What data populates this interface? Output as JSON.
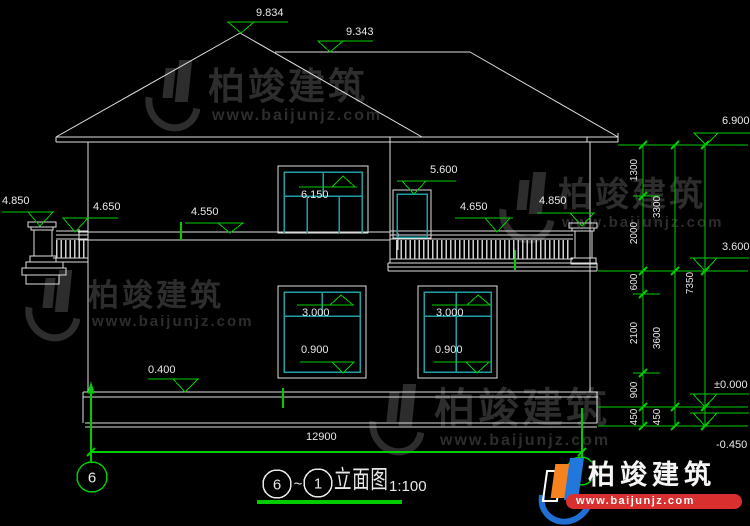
{
  "drawing": {
    "title": {
      "axis_left": "6",
      "separator": "~",
      "axis_right": "1",
      "name": "立面图",
      "scale": "1:100"
    },
    "axis_bubble_left": "6",
    "elevations": {
      "roof_peak": "9.834",
      "roof_ridge": "9.343",
      "eave": "6.900",
      "door2f_head": "6.150",
      "window2f_head": "5.600",
      "parapet_left": "4.850",
      "railing_left": "4.650",
      "belt": "4.550",
      "railing_right": "4.650",
      "parapet_right": "4.850",
      "window_head": "3.000",
      "window_sill": "0.900",
      "plinth_top": "0.400",
      "floor2": "3.600",
      "zero": "±0.000",
      "grade": "-0.450"
    },
    "dims": {
      "overall": "12900",
      "inner": [
        "1300",
        "2000",
        "600",
        "2100",
        "900",
        "450"
      ],
      "middle": [
        "3300",
        "3600",
        "450"
      ],
      "outer": "7350"
    }
  },
  "watermark": {
    "brand": "柏竣建筑",
    "url": "www.baijunjz.com"
  },
  "logo": {
    "brand": "柏竣建筑",
    "url": "www.baijunjz.com"
  }
}
